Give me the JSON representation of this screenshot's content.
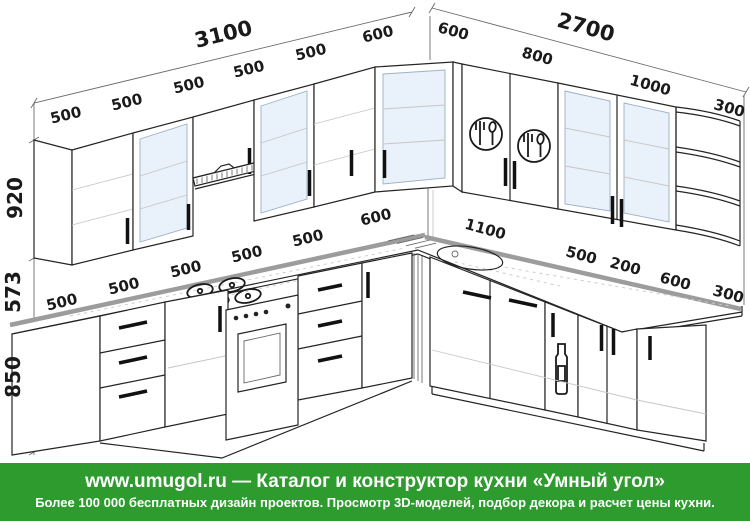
{
  "drawing": {
    "type": "kitchen-layout-perspective",
    "dims": {
      "left_total": "3100",
      "right_total": "2700",
      "left_wall": [
        "500",
        "500",
        "500",
        "500",
        "500",
        "600"
      ],
      "right_wall": [
        "600",
        "800",
        "1000",
        "300"
      ],
      "left_base": [
        "500",
        "500",
        "500",
        "500",
        "500",
        "600"
      ],
      "right_base": [
        "1100",
        "500",
        "200",
        "600",
        "300"
      ],
      "wall_cabinet_height": "920",
      "apron_height": "573",
      "base_height": "850"
    },
    "icons": {
      "cutlery": "fork-spoon-circle",
      "hood": "extractor-hood",
      "hob": "gas-hob-4-burners",
      "oven": "oven-window",
      "sink": "round-bowl-sink",
      "bottle": "bottle-cabinet",
      "corner_shelf": "quarter-round-open-shelves"
    },
    "colors": {
      "line": "#222222",
      "glass": "#e9f1fa",
      "counter_edge": "#9c9c9c"
    }
  },
  "footer": {
    "line1": "www.umugol.ru — Каталог и конструктор кухни «Умный угол»",
    "line2": "Более 100 000 бесплатных дизайн проектов. Просмотр 3D-моделей, подбор декора и расчет цены кухни.",
    "bg": "#2e9b2e",
    "text_color": "#ffffff"
  }
}
